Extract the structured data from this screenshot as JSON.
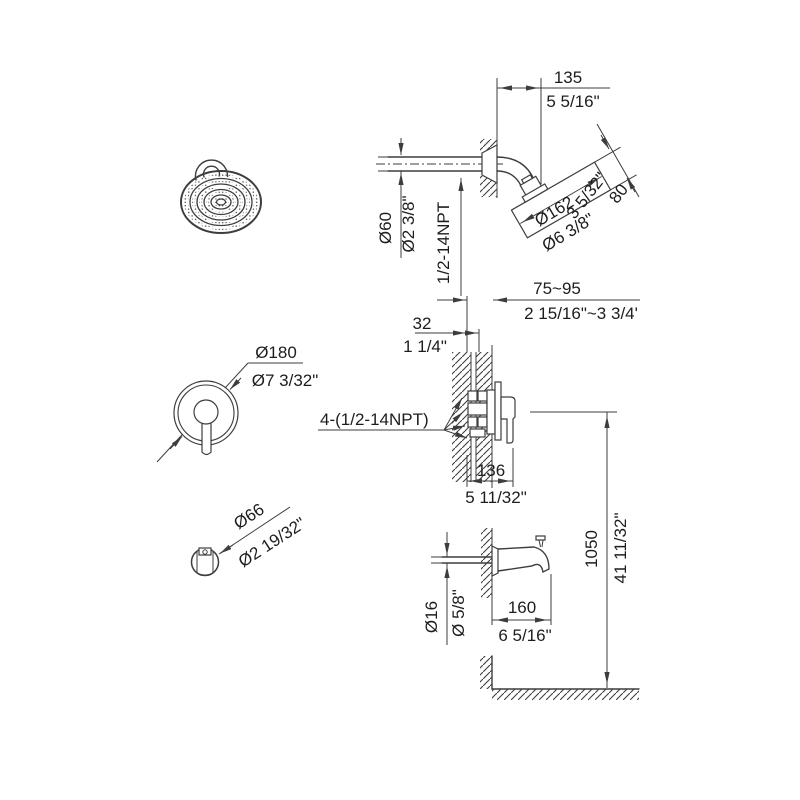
{
  "drawing": {
    "type": "installation-dimension-diagram",
    "colors": {
      "line": "#3d3d3d",
      "text": "#1d1d1d",
      "background": "#ffffff"
    }
  },
  "dims": {
    "head_offset_mm": "135",
    "head_offset_in": "5 5/16\"",
    "head_depth_mm": "80",
    "head_depth_in": "3 5/32\"",
    "head_dia_mm": "Ø162",
    "head_dia_in": "Ø6 3/8\"",
    "arm_dia_mm": "Ø60",
    "arm_dia_in": "Ø2 3/8\"",
    "arm_thread": "1/2-14NPT",
    "valve_depth_mm": "75~95",
    "valve_depth_in": "2 15/16\"~3 3/4'",
    "valve_offset_mm": "32",
    "valve_offset_in": "1 1/4\"",
    "valve_thread": "4-(1/2-14NPT)",
    "valve_width_mm": "136",
    "valve_width_in": "5 11/32\"",
    "handle_dia_mm": "Ø180",
    "handle_dia_in": "Ø7 3/32\"",
    "spout_front_dia_mm": "Ø66",
    "spout_front_dia_in": "Ø2 19/32\"",
    "spout_pipe_dia_mm": "Ø16",
    "spout_pipe_dia_in": "Ø 5/8\"",
    "spout_len_mm": "160",
    "spout_len_in": "6 5/16\"",
    "height_mm": "1050",
    "height_in": "41 11/32\""
  }
}
